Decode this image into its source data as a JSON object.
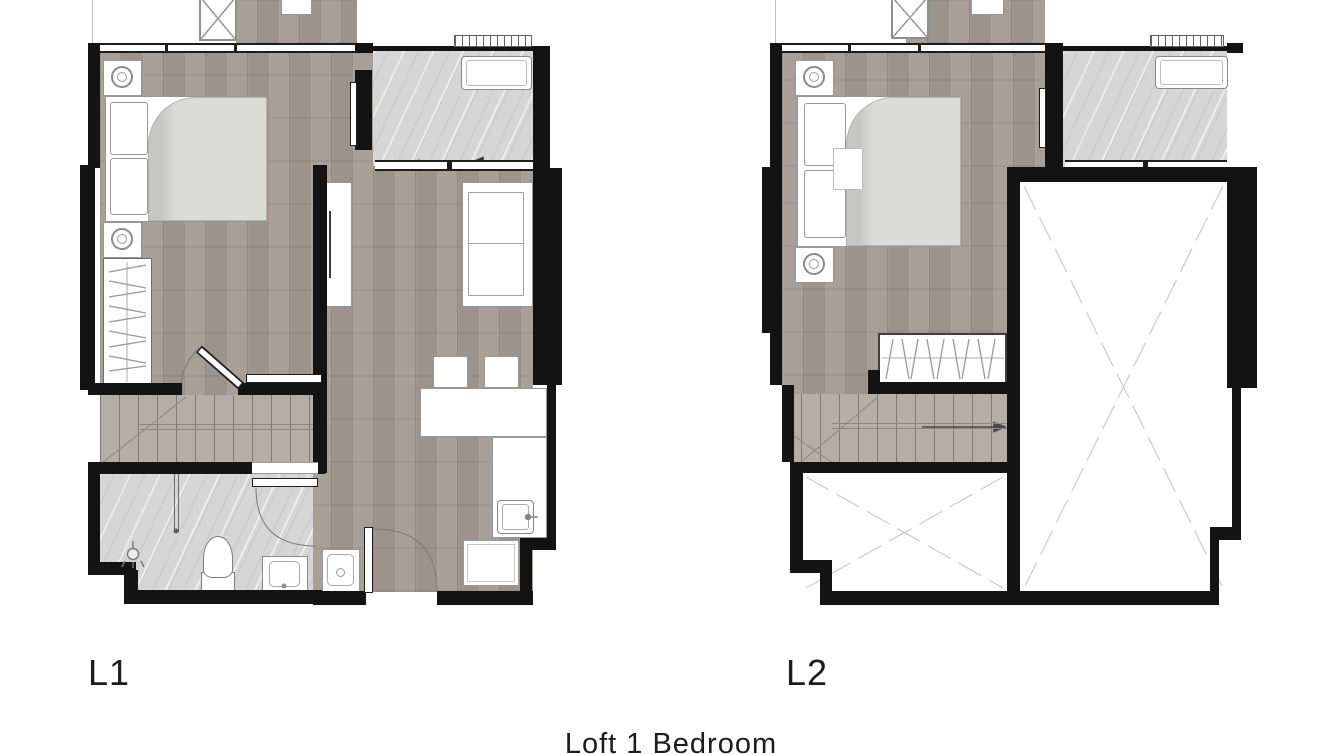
{
  "title": "Loft 1 Bedroom",
  "plans": [
    {
      "id": "l1",
      "label": "L1"
    },
    {
      "id": "l2",
      "label": "L2"
    }
  ],
  "colors": {
    "background": "#ffffff",
    "wall": "#131313",
    "wood_floor": "#a49b92",
    "stair_floor": "#b5aea7",
    "tile_floor": "#d6d6d7",
    "void_line": "#cbcbcb",
    "furniture_outline": "#979797",
    "label_text": "#1c1c1c"
  },
  "symbols": {
    "lamp-icon": "double-circle",
    "hanger-icon": "angled-strokes-on-rail",
    "ac-unit-icon": "x-hatched-square",
    "shower-icon": "circle-with-spray-lines",
    "sliding-door-arrow-icon": "horizontal-arrows",
    "stair-direction-arrow-icon": "right-arrow",
    "void-icon": "crossed-diagonals"
  }
}
